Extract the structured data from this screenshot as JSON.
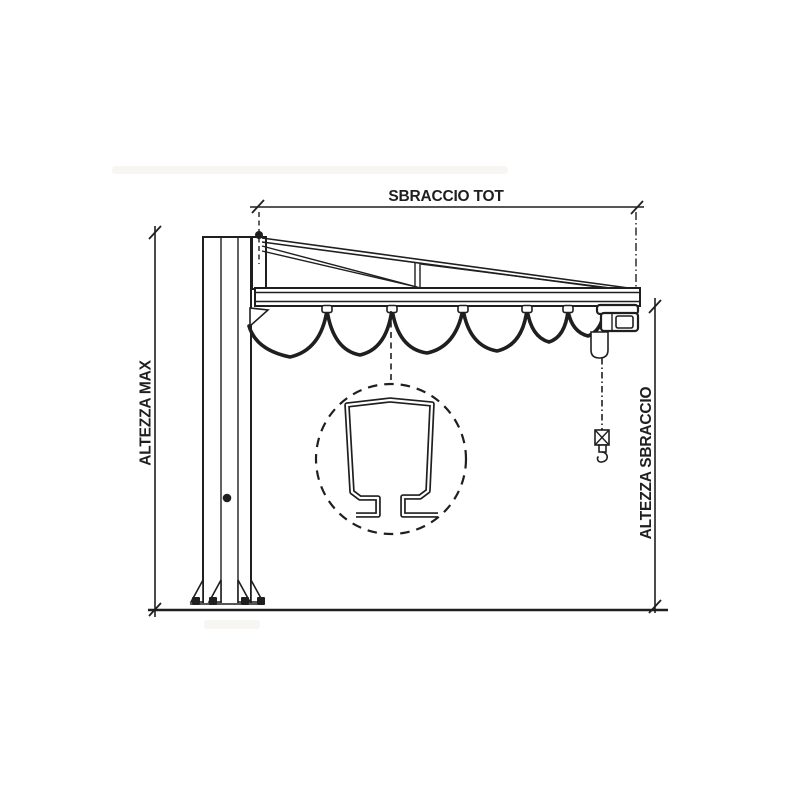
{
  "labels": {
    "sbraccio_tot": "SBRACCIO TOT",
    "altezza_max": "ALTEZZA MAX",
    "altezza_sbraccio": "ALTEZZA SBRACCIO"
  },
  "colors": {
    "line": "#1f1f1f",
    "background": "#ffffff"
  }
}
